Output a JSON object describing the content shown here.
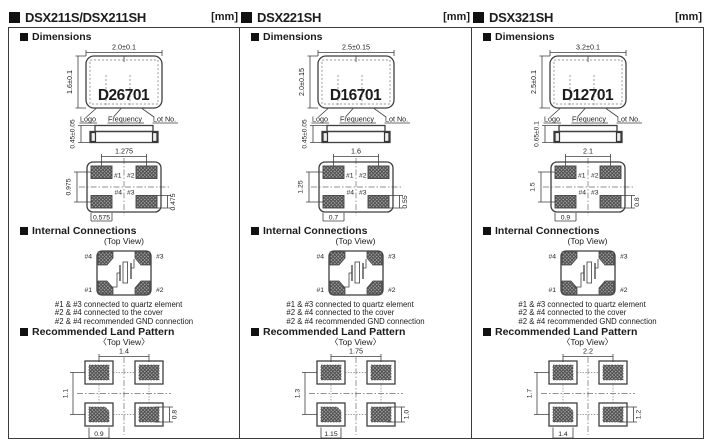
{
  "sections": {
    "dimensions": "Dimensions",
    "internal_connections": "Internal Connections",
    "land_pattern": "Recommended Land Pattern",
    "top_view_paren": "(Top View)",
    "top_view_angle": "〈Top View〉"
  },
  "pin_labels": {
    "p1": "#1",
    "p2": "#2",
    "p3": "#3",
    "p4": "#4"
  },
  "marking_labels": {
    "logo": "Logo",
    "frequency": "Frequency",
    "lot": "Lot No."
  },
  "internal_notes": [
    "#1 & #3 connected to quartz element",
    "#2 & #4 connected to the cover",
    "#2 & #4 recommended GND connection"
  ],
  "panels": [
    {
      "title": "DSX211S/DSX211SH",
      "unit": "[mm]",
      "marking": "D26701",
      "package": {
        "width": "2.0±0.1",
        "height": "1.6±0.1",
        "thickness": "0.45±0.05"
      },
      "bottom_view": {
        "top": "1.275",
        "left": "0.975",
        "bottom": "0.575",
        "right": "0.475"
      },
      "land": {
        "top": "1.4",
        "left": "1.1",
        "bottom": "0.9",
        "right": "0.8"
      }
    },
    {
      "title": "DSX221SH",
      "unit": "[mm]",
      "marking": "D16701",
      "package": {
        "width": "2.5±0.15",
        "height": "2.0±0.15",
        "thickness": "0.45±0.05"
      },
      "bottom_view": {
        "top": "1.6",
        "left": "1.25",
        "bottom": "0.7",
        "right": "0.55"
      },
      "land": {
        "top": "1.75",
        "left": "1.3",
        "bottom": "1.15",
        "right": "1.0"
      }
    },
    {
      "title": "DSX321SH",
      "unit": "[mm]",
      "marking": "D12701",
      "package": {
        "width": "3.2±0.1",
        "height": "2.5±0.1",
        "thickness": "0.65±0.1"
      },
      "bottom_view": {
        "top": "2.1",
        "left": "1.5",
        "bottom": "0.9",
        "right": "0.8"
      },
      "land": {
        "top": "2.2",
        "left": "1.7",
        "bottom": "1.4",
        "right": "1.2"
      }
    }
  ]
}
